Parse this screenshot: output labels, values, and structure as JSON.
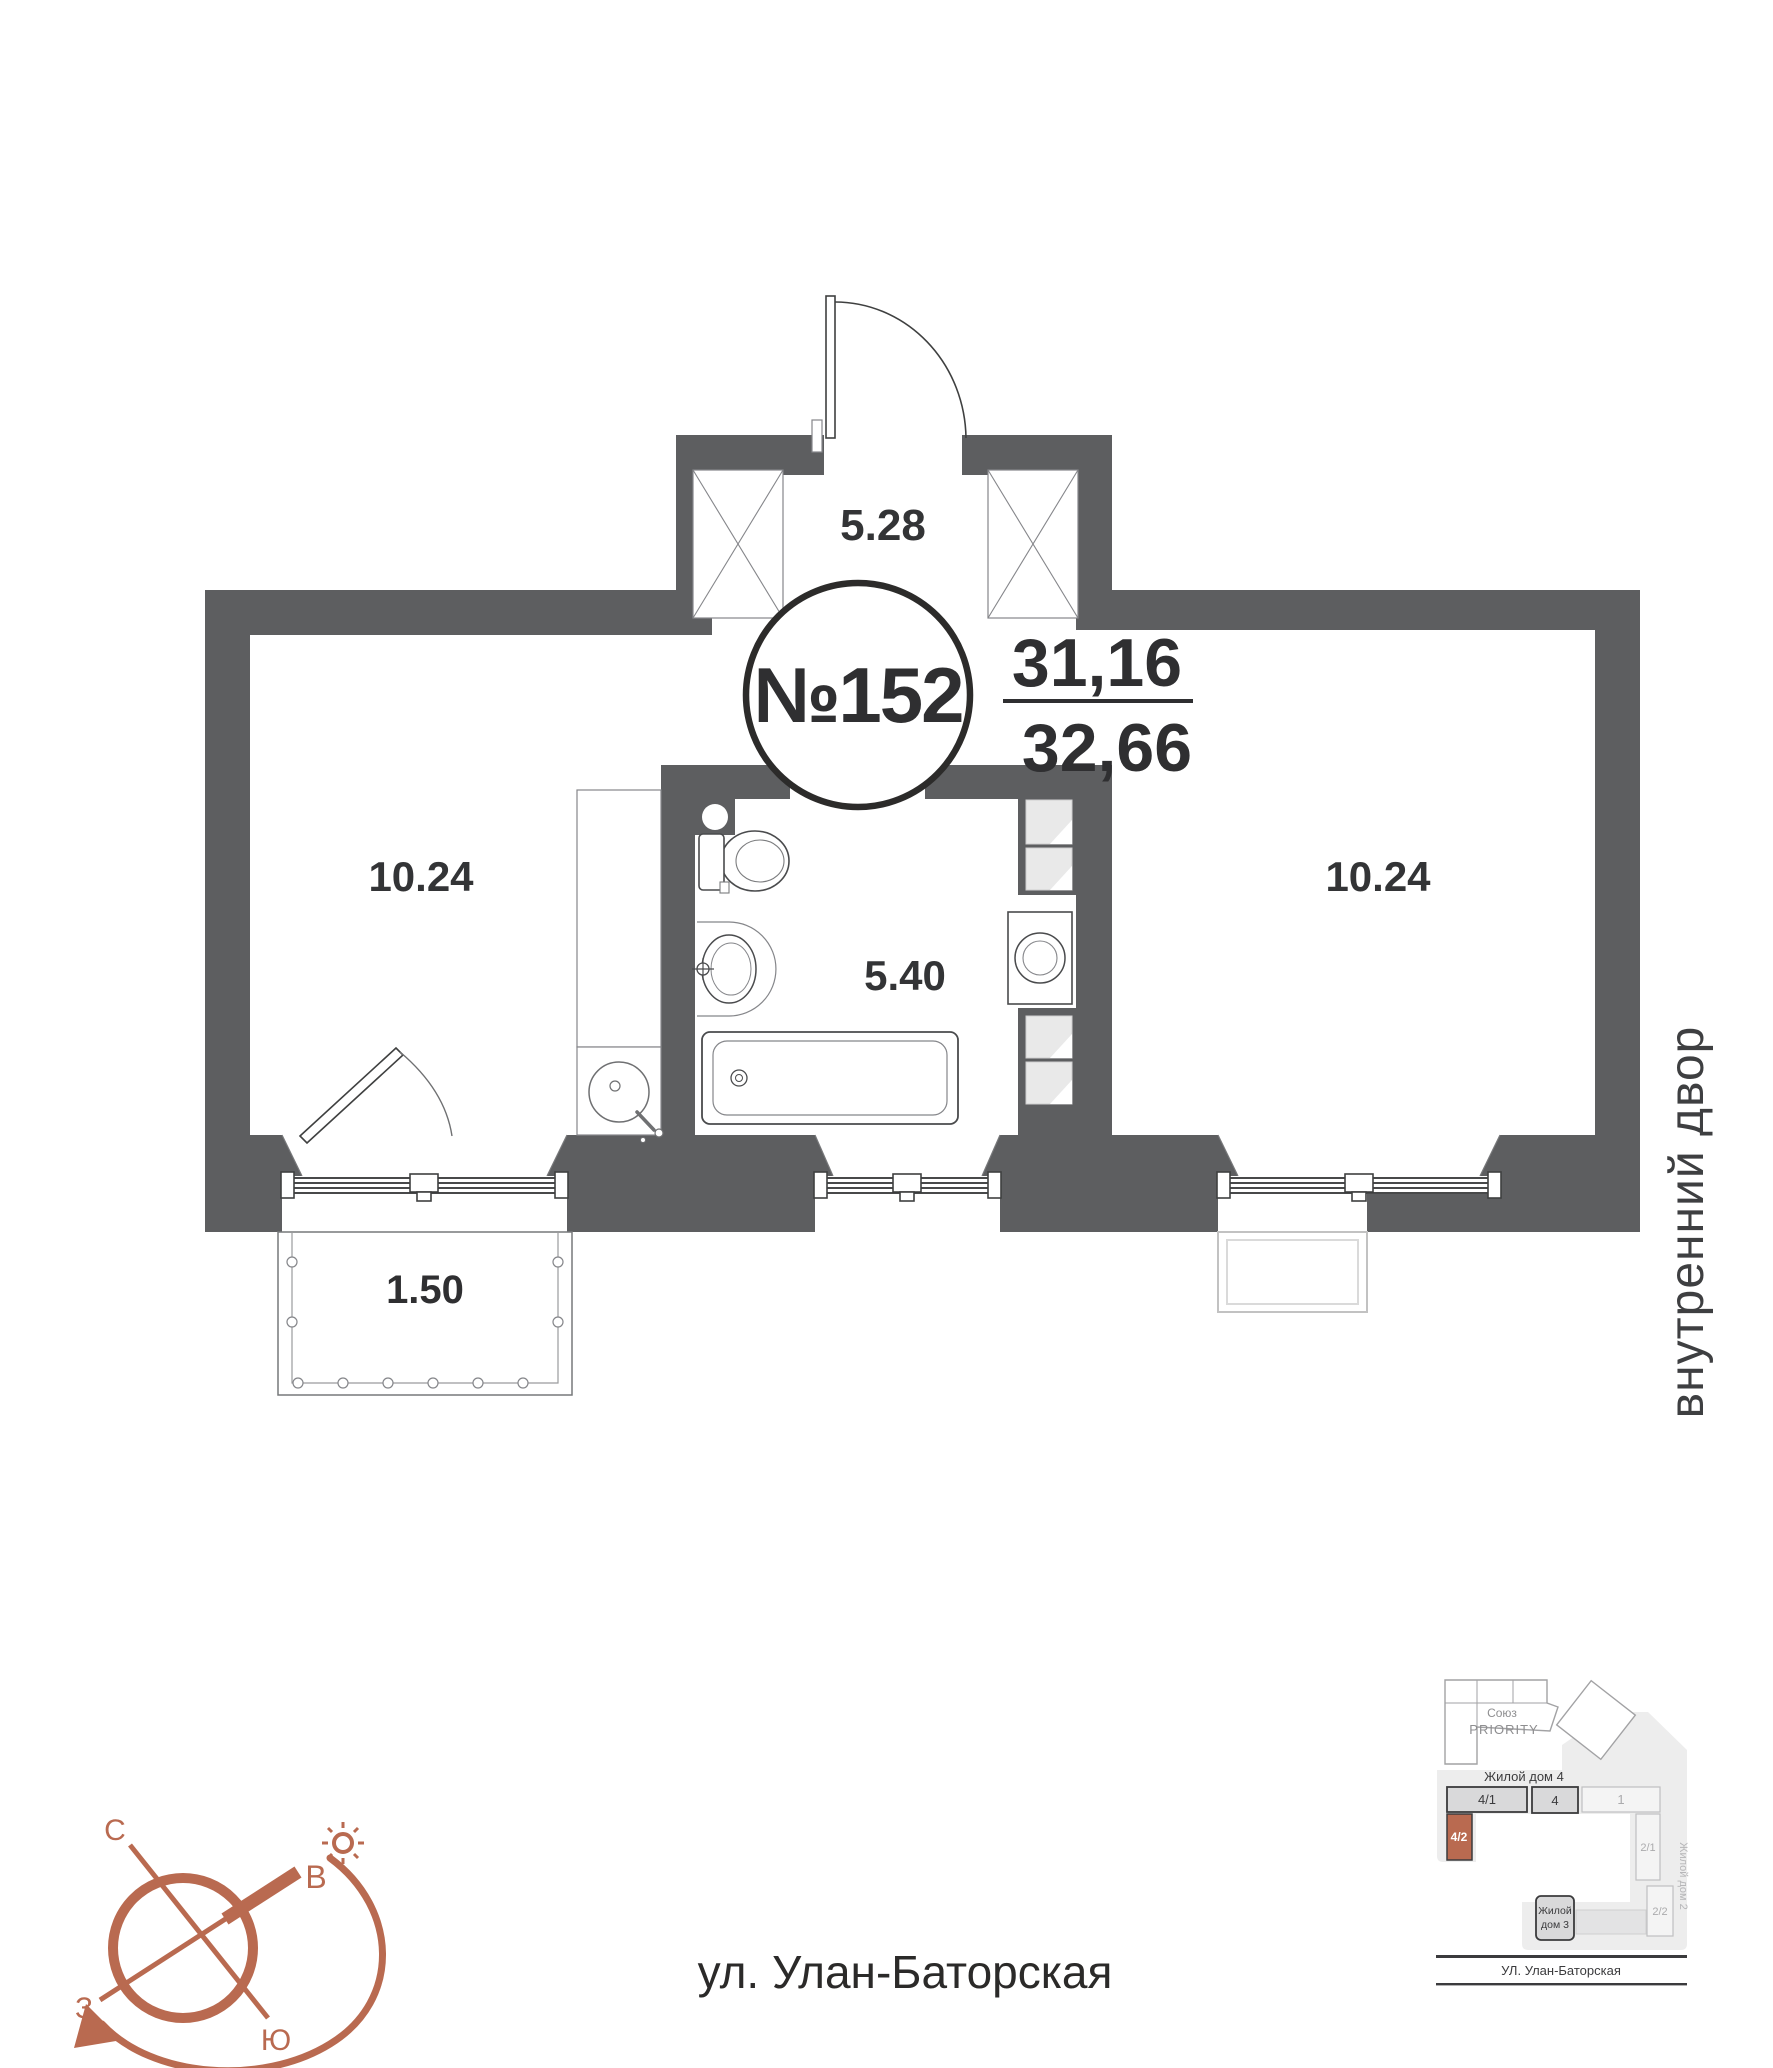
{
  "colors": {
    "wall": "#5d5e60",
    "line": "#3f4040",
    "accent": "#b96a50",
    "ink": "#2f2f31"
  },
  "plan": {
    "number": "№152",
    "area_living": "31,16",
    "area_total": "32,66",
    "labels": {
      "hallway": "5.28",
      "left_room": "10.24",
      "right_room": "10.24",
      "bathroom": "5.40",
      "balcony": "1.50"
    },
    "courtyard": "внутренний двор",
    "street": "ул. Улан-Баторская"
  },
  "compass": {
    "n": "С",
    "e": "В",
    "w": "З",
    "s": "Ю"
  },
  "minimap": {
    "complex": {
      "line1": "Союз",
      "line2": "PRIORITY"
    },
    "house4": "Жилой дом 4",
    "house2": "Жилой дом 2",
    "house3": {
      "line1": "Жилой",
      "line2": "дом 3"
    },
    "units": {
      "u41": "4/1",
      "u4": "4",
      "u1": "1",
      "u42": "4/2",
      "u21": "2/1",
      "u22": "2/2"
    },
    "street": "УЛ. Улан-Баторская"
  }
}
